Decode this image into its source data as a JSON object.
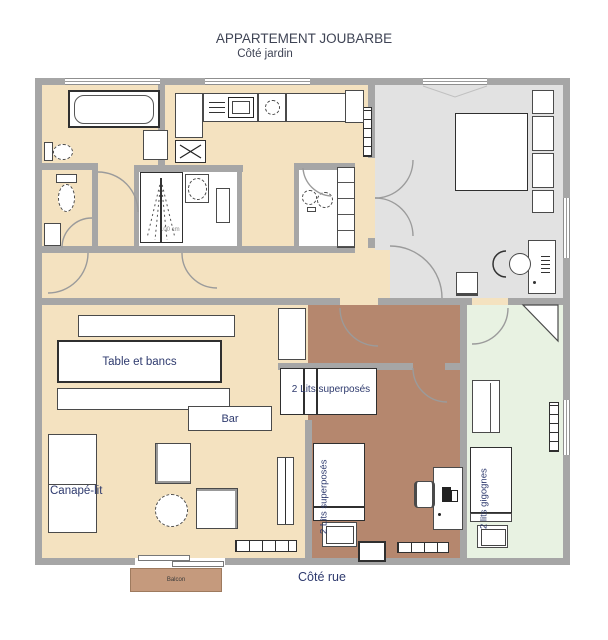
{
  "header": {
    "title": "APPARTEMENT JOUBARBE",
    "subtitle": "Côté jardin"
  },
  "footer": {
    "street_side_label": "Côté rue",
    "balcony_label": "Balcon"
  },
  "colors": {
    "wall": "#a6a6a6",
    "floor_main": "#f4e2c0",
    "floor_gray_bedroom": "#e2e2e2",
    "floor_brown_bedroom": "#b5876e",
    "floor_green_bedroom": "#e8f2e2",
    "balcony_fill": "#c59a7d",
    "label_text": "#2e3a6e"
  },
  "rooms": {
    "living_room": {
      "table_label": "Table et bancs",
      "bar_label": "Bar",
      "sofa_bed_label": "Canapé-lit"
    },
    "bunk_bedroom": {
      "bunk_bed_horizontal_label": "2 Lits superposés",
      "bunk_bed_vertical_label": "2 Lits superposés"
    },
    "trundle_bedroom": {
      "trundle_bed_label": "2 lits gigognes"
    },
    "shower_room": {
      "shower_width_label": "100 cm"
    }
  }
}
